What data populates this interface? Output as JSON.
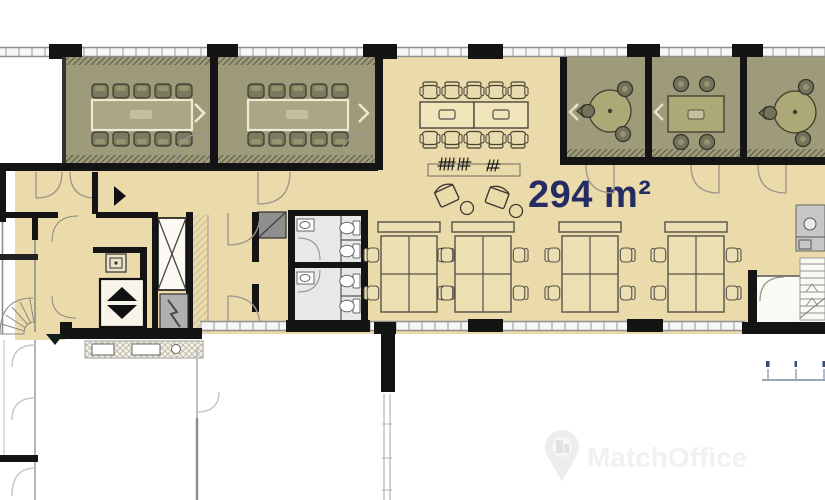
{
  "plan": {
    "area_label": "294 m²",
    "area_label_color": "#252b63",
    "colors": {
      "highlighted_floor": "#ecdbaa",
      "meeting_room_floor": "#9d9b7a",
      "wall": "#141414",
      "wc_floor": "#e8e8e8"
    },
    "rooms": {
      "large_meeting_rooms": 2,
      "small_meeting_rooms": 3,
      "open_plan_desk_clusters": 4,
      "toilet_groups": 2,
      "elevators": 2,
      "staircases": 2
    }
  },
  "watermark": {
    "brand": "MatchOffice",
    "icon": "location-pin-building-icon",
    "color": "#f1f1f1"
  }
}
